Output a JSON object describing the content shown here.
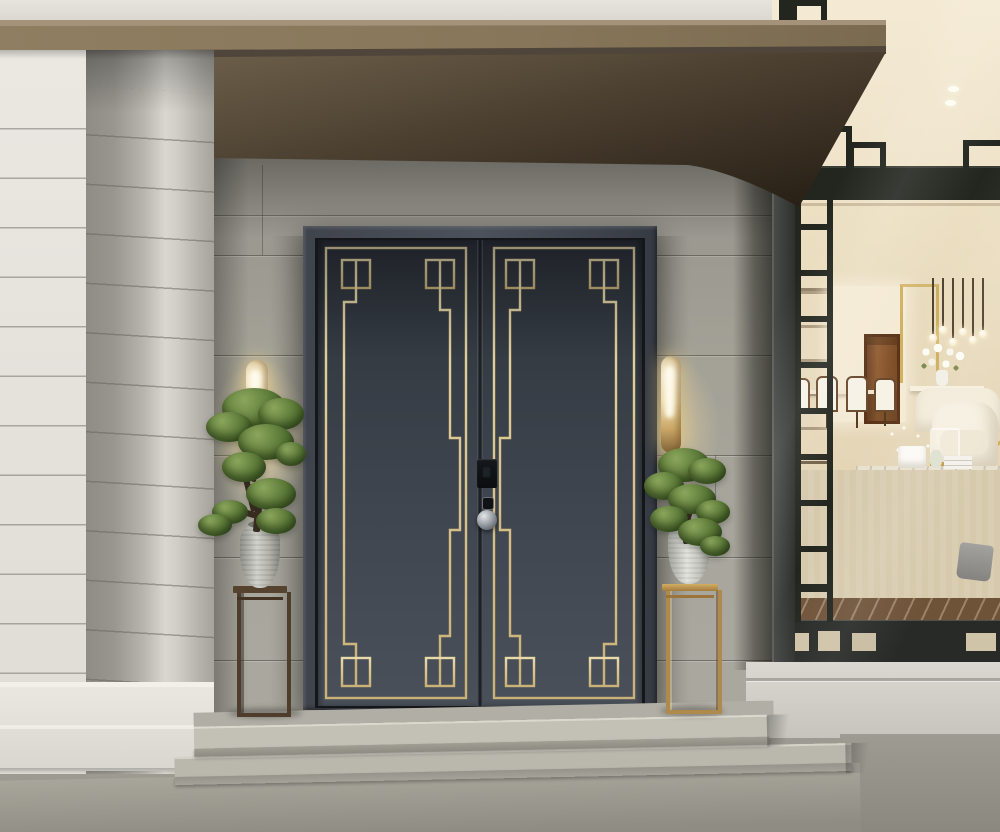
{
  "meta": {
    "kind": "photorealistic exterior render",
    "width_px": 1000,
    "height_px": 832,
    "visible_text": "none"
  },
  "labels": {
    "scene": "Modern Chinese villa entrance with double doors",
    "roof": "Bronze roof canopy and dark soffit",
    "front_wall": "White grooved stone wall",
    "porch_wall": "Grey stone porch back wall",
    "door": "Charcoal double entry doors with brass fret inlay",
    "door_frame": "Dark metal door frame",
    "smart_lock": "Black smart lock panel",
    "keyhole": "Keyhole",
    "door_knob": "Round chrome door knob",
    "left_sconce": "Glowing brass wall sconce (left)",
    "right_sconce": "Glowing brass wall sconce (right)",
    "left_bonsai": "Bonsai in ceramic jar on dark wood stand",
    "right_bonsai": "Bonsai in ceramic jar on brass stand",
    "window": "Black lattice picture window",
    "interior": "Luxury cream living room with gold coffee table, pendant lights, dining chairs and wooden door",
    "steps": "Granite entrance steps",
    "ground": "Granite paving",
    "plinth": "Light stone plinth below window"
  },
  "palette": {
    "door_leaf": "#3e444d",
    "gold_inlay": "#d9c48c",
    "door_frame": "#42474f",
    "fascia": "#877659",
    "soffit_dark": "#2c2519",
    "porch_wall": "#a19f95",
    "front_wall": "#e6e4dd",
    "step_stone": "#c2c0b5",
    "ground": "#9b998f",
    "lattice": "#23261f",
    "interior_cream": "#eee2c8",
    "interior_gold": "#c39d4b",
    "floor_border": "#6f5339",
    "brass_stand": "#b08a4c",
    "dark_stand": "#4e3c2c",
    "foliage": "#5c7a38",
    "sconce_glow": "#f5e3b2",
    "vase": "#c6c6c0",
    "knob_chrome": "#9ba0a6"
  }
}
